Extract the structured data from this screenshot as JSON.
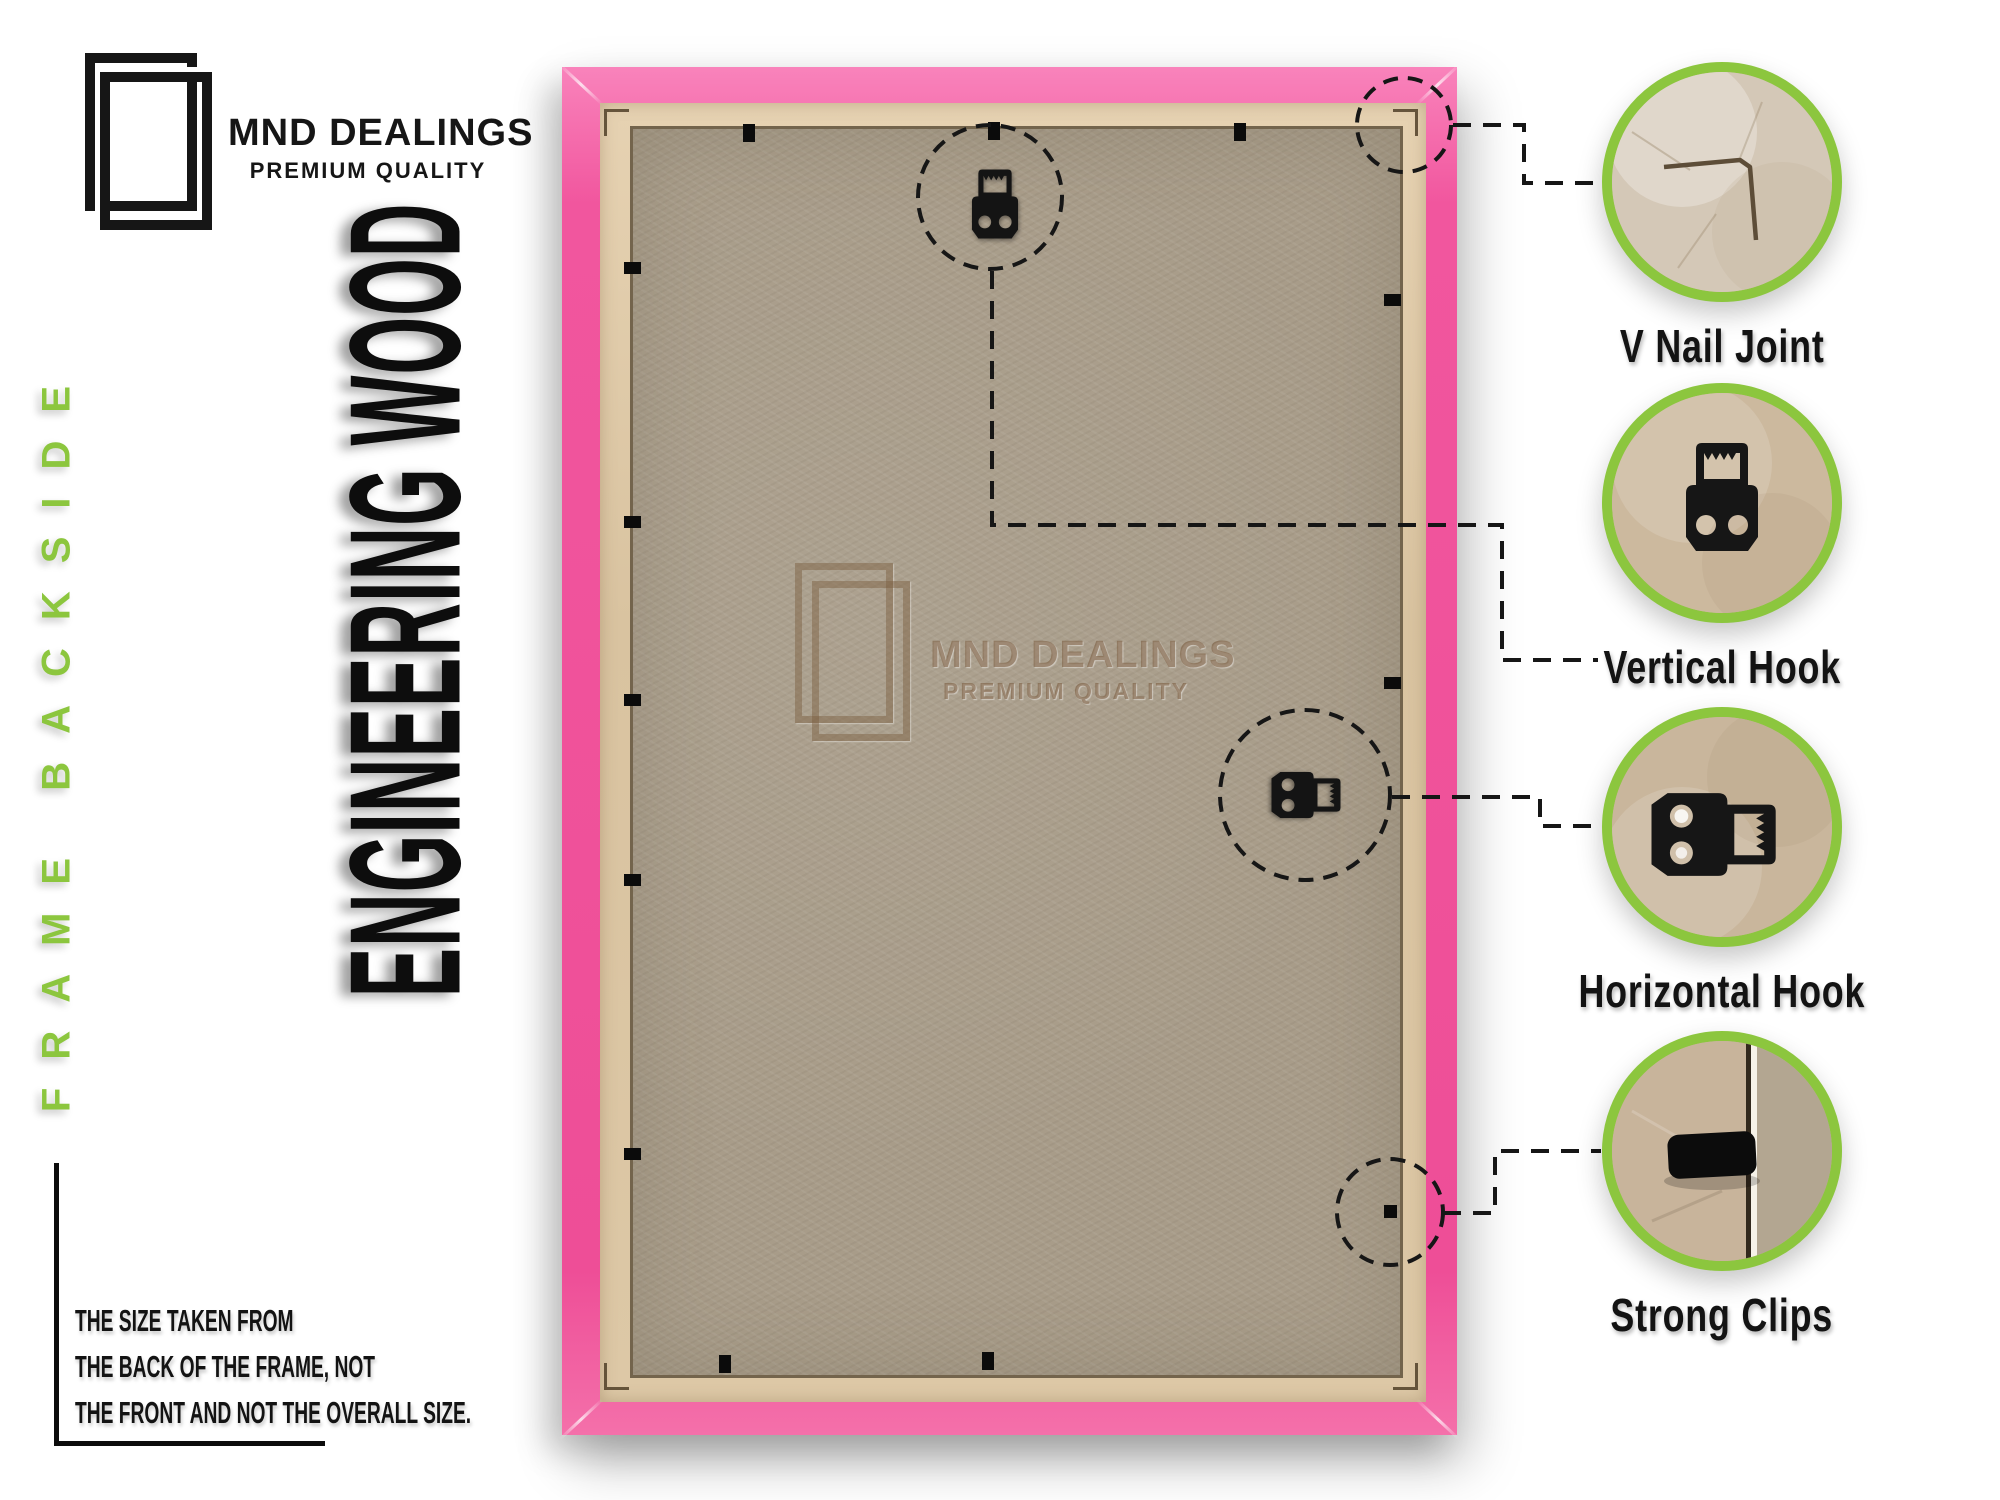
{
  "brand": {
    "name": "MND DEALINGS",
    "tagline": "PREMIUM QUALITY"
  },
  "side_label": "FRAME BACKSIDE",
  "material_label": "ENGINEERING WOOD",
  "watermark": {
    "name": "MND DEALINGS",
    "tagline": "PREMIUM QUALITY"
  },
  "callouts": [
    {
      "id": "v-nail-joint",
      "label": "V Nail Joint"
    },
    {
      "id": "vertical-hook",
      "label": "Vertical Hook"
    },
    {
      "id": "horizontal-hook",
      "label": "Horizontal Hook"
    },
    {
      "id": "strong-clips",
      "label": "Strong Clips"
    }
  ],
  "note_lines": [
    "THE SIZE TAKEN FROM",
    "THE BACK OF THE FRAME, NOT",
    "THE FRONT AND NOT THE OVERALL SIZE."
  ],
  "colors": {
    "accent_green": "#8cc63e",
    "frame_pink": "#f1569e",
    "wood_lip": "#ddc8a6",
    "backboard": "#a89c89",
    "ink": "#141414"
  }
}
